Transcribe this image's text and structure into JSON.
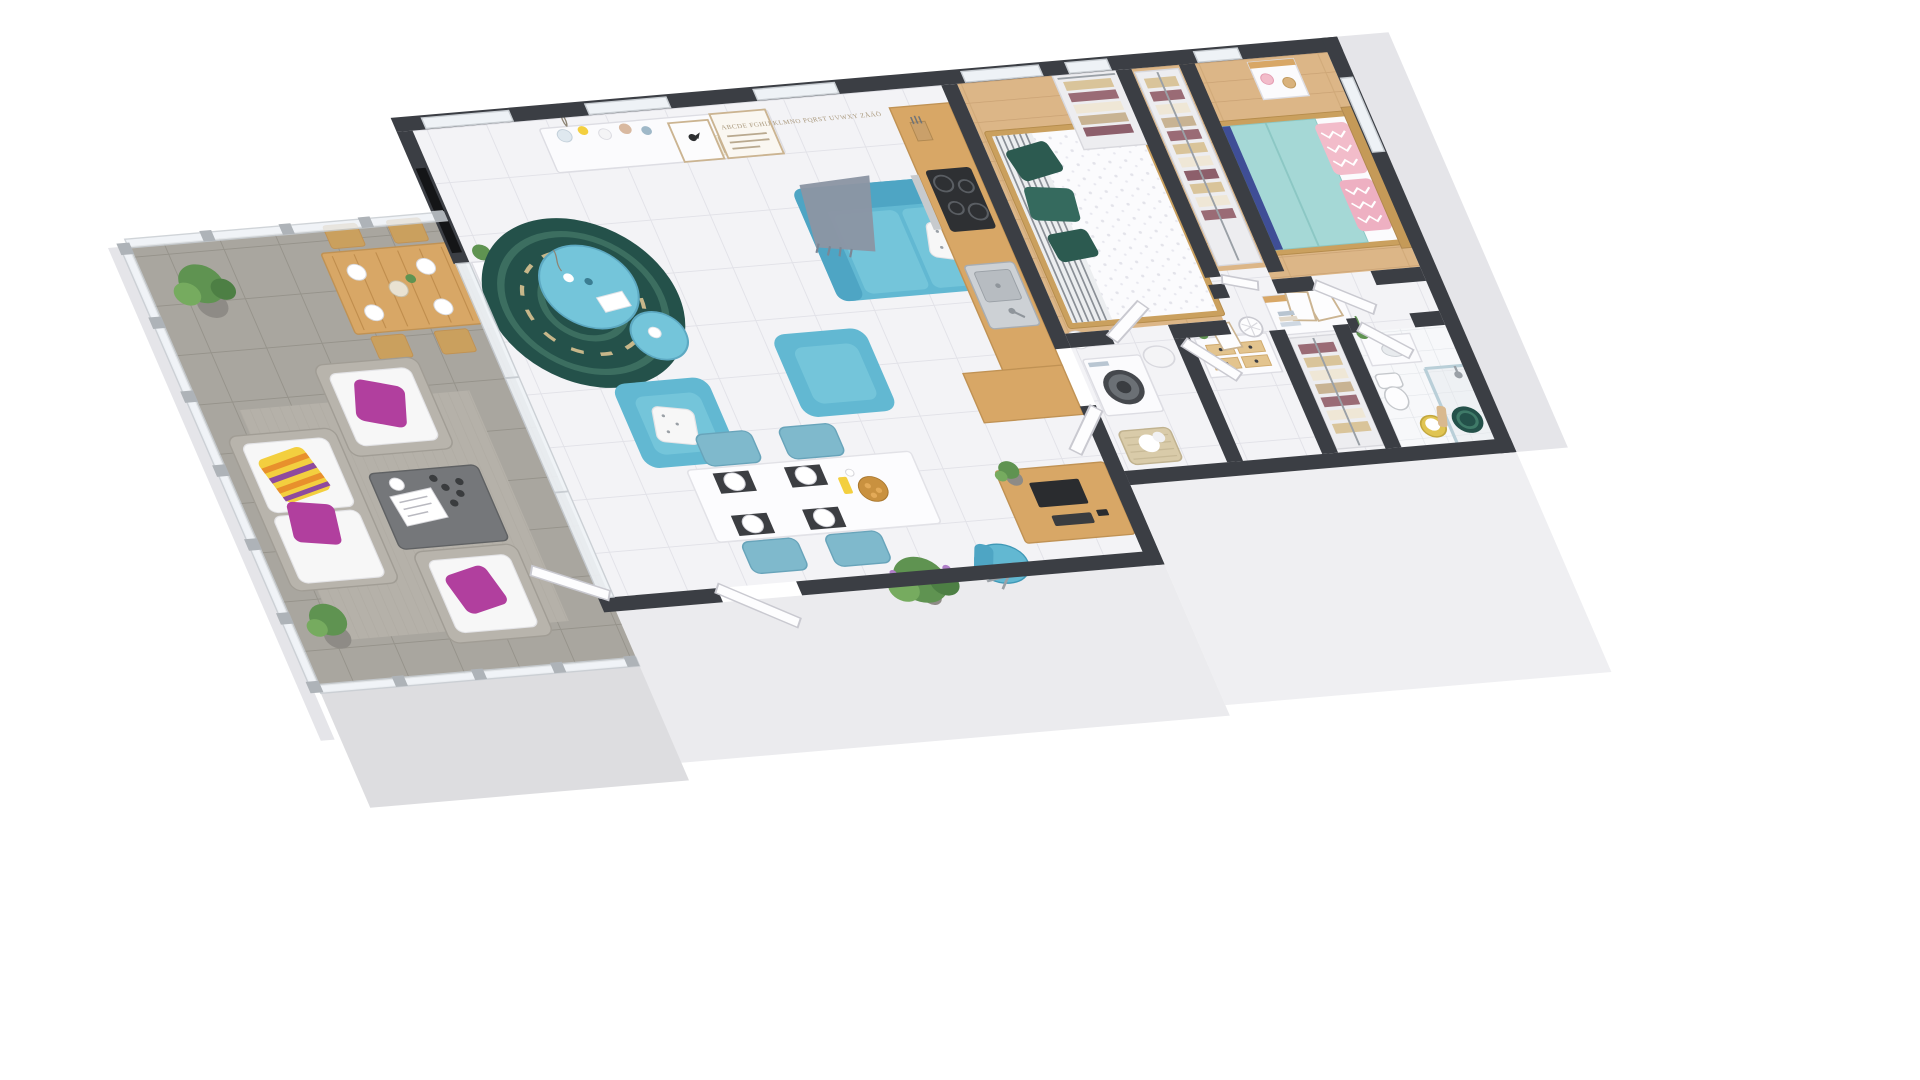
{
  "scene": {
    "type": "3d-isometric-floorplan-render",
    "background": "#ffffff",
    "description": "Cut-away 3D floor plan of an apartment viewed from above at an angle: large tiled terrace on the left, open-plan living / dining / kitchen in the centre, hallway, two bedrooms, closets, laundry and bathroom on the right, dark charcoal wall tops, light grey exterior wall faces"
  },
  "poster": {
    "letters": "ABCDE FGHIJ KLMNO PQRST UVWXY ZÅÄÖ"
  },
  "colors": {
    "wall_top": "#3b3e44",
    "wall_dark": "#2e3136",
    "ext_light": "#efeff2",
    "ext_light2": "#ebebee",
    "ext_mid": "#e5e5e9",
    "ext_face": "#dddde0",
    "living_floor": "#f3f3f6",
    "living_grout": "#e2e2e8",
    "terrace_floor": "#a9a69f",
    "terrace_grout": "#96938b",
    "terrace_rug": "#b5b1a9",
    "wood_floor": "#dcb687",
    "wood_seam": "#c9a173",
    "wood": "#d8a766",
    "wood_dark": "#c09254",
    "wood_mid": "#caa05e",
    "glass": "#eef2f6",
    "glass_frame": "#c8cdd2",
    "balustrade_post": "#aeb3b8",
    "sofa_teal": "#62b8d2",
    "sofa_teal_dark": "#4ea5c4",
    "sofa_teal_light": "#74c5da",
    "chair_blue": "#7fb9cc",
    "chair_blue_dark": "#68a4ba",
    "rug_green": "#24514a",
    "rug_ring": "#3c6e60",
    "rug_tan": "#c7b78a",
    "magenta": "#b13f9e",
    "stripe_yellow": "#f3cf3f",
    "stripe_orange": "#e8902c",
    "stripe_purple": "#8e4a9e",
    "pillow_yellow": "#eed94e",
    "throw_gray": "#8b95a3",
    "cushion_white": "#f7f7f7",
    "rattan": "#b8b4ac",
    "rattan_dark": "#a19d95",
    "table_gray": "#75777a",
    "duvet_white": "#fbfbfd",
    "duvet_aqua": "#a5d8d6",
    "aqua_dark": "#8cc7c4",
    "pillow_pink": "#f2bcca",
    "pillow_green": "#2c5a50",
    "pillow_green2": "#356a5e",
    "runner_blue": "#3f4e96",
    "stripe_gray": "#8a8f96",
    "appliance_dark": "#2e3033",
    "steel": "#cdd1d5",
    "steel_dark": "#a8adb2",
    "door_white": "#fdfdfe",
    "door_stroke": "#c9c9d0",
    "furn_white": "#fbfbfd",
    "furn_stroke": "#dddde3",
    "plant_green": "#5f9351",
    "plant_light": "#76ab5f",
    "plant_dark": "#4d7f44",
    "pot_gray": "#8e8b86",
    "clothes_tan": "#d9c49a",
    "clothes_maroon": "#9a6b75",
    "clothes_cream": "#efe7d6",
    "bath_tile": "#f7f8fa",
    "bath_grout": "#e2e5e9",
    "basket_yellow": "#e0c452",
    "basket_tan": "#d9cba9",
    "towel_tan": "#d9b98e",
    "poster_frame": "#cbb491",
    "poster_text": "#a9987c",
    "tv_black": "#141517"
  },
  "rooms": [
    {
      "name": "terrace",
      "floor": "grey stone tiles with glass balustrade",
      "items": [
        "wooden outdoor dining table",
        "4 wooden folding chairs",
        "place settings",
        "rattan sofa with white cushions",
        "2 rattan armchairs",
        "magenta cushions",
        "striped orange-yellow-purple cushion",
        "grey rattan coffee table with magazine and cups",
        "2 potted trees",
        "outdoor rug"
      ]
    },
    {
      "name": "living-room",
      "floor": "white tiles",
      "items": [
        "teal 3-seat sofa",
        "grey throw blanket",
        "white dotted cushion",
        "yellow cushion",
        "2 teal armchairs",
        "round teal coffee table set",
        "dark green spiral rug",
        "white sideboard with vases",
        "typography letter poster",
        "bird poster",
        "wall mounted tv",
        "tv cabinet with plants"
      ]
    },
    {
      "name": "dining-area",
      "floor": "white tiles",
      "items": [
        "white dining table",
        "4 light blue chairs",
        "black placemats",
        "white plates",
        "bowl of pastries",
        "yellow bottle",
        "potted fern"
      ]
    },
    {
      "name": "kitchen",
      "items": [
        "wooden worktop",
        "induction hob",
        "stainless sink",
        "knife block",
        "white cabinets",
        "corner worktop unit"
      ]
    },
    {
      "name": "bedroom-1",
      "floor": "wood",
      "items": [
        "double bed",
        "white patterned duvet",
        "grey striped runner",
        "dark green pillows",
        "white floor lamp",
        "open wardrobe with hanging clothes"
      ]
    },
    {
      "name": "corridor-closet",
      "items": [
        "hanging clothes on rail"
      ]
    },
    {
      "name": "bedroom-2",
      "floor": "wood",
      "items": [
        "double bed with wooden headboard",
        "aqua duvet",
        "pink zigzag pillows",
        "nightstand",
        "pink lamp",
        "clock"
      ]
    },
    {
      "name": "hallway",
      "items": [
        "white dresser with wooden drawers",
        "cactus",
        "leaning picture frame",
        "white decorative lantern",
        "dresser with leaning frames and book stack",
        "white doors"
      ]
    },
    {
      "name": "laundry",
      "items": [
        "washing machine",
        "water heater",
        "laundry basket"
      ]
    },
    {
      "name": "bathroom",
      "floor": "light tiles",
      "items": [
        "vanity with basin",
        "bamboo plant",
        "toilet",
        "walk-in shower with glass panel",
        "shower head",
        "green spiral rug",
        "yellow towel basket",
        "hanging towel"
      ]
    }
  ]
}
